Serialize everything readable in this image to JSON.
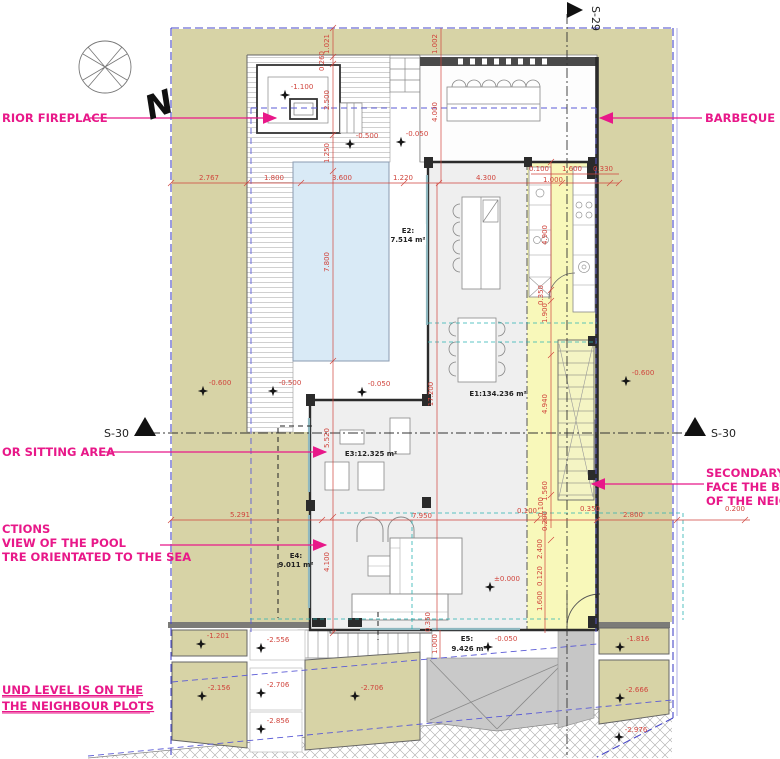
{
  "colors": {
    "plot_khaki": "#d7d3a6",
    "pool_blue": "#d9eaf6",
    "service_yellow": "#f8f8b6",
    "annotation_pink": "#e81889",
    "dimension_red": "#d0443c",
    "boundary_blue": "#4848c8",
    "canopy_cyan": "#2ab3b3"
  },
  "icons": {
    "level_marker": "four-point-star",
    "section_marker": "filled-triangle",
    "callout_arrow": "filled-arrow",
    "compass": "compass-rose"
  },
  "compass": {
    "north": "N"
  },
  "sections": {
    "top": "S-29",
    "left": "S-30",
    "right": "S-30"
  },
  "callouts": {
    "fireplace": "RIOR FIREPLACE",
    "barbeque": "BARBEQUE",
    "sitting_area": "OR SITTING AREA",
    "pool_note": [
      "CTIONS",
      "VIEW OF THE POOL",
      "TRE ORIENTATED TO THE SEA"
    ],
    "secondary_note": [
      "SECONDARY F",
      "FACE THE BLI",
      "OF THE NEIGH"
    ],
    "ground_note": [
      "UND LEVEL IS ON THE",
      "THE NEIGHBOUR PLOTS"
    ]
  },
  "rooms": {
    "e1": "E1:134.236 m²",
    "e2_name": "E2:",
    "e2_area": "7.514 m²",
    "e3": "E3:12.325 m²",
    "e4_name": "E4:",
    "e4_area": "9.011 m²",
    "e5_name": "E5:",
    "e5_area": "9.426 m²"
  },
  "dims_h": [
    "2.767",
    "1.800",
    "3.600",
    "1.220",
    "4.300",
    "0.100",
    "1.600",
    "0.330",
    "1.000",
    "5.291",
    "7.950",
    "0.100",
    "0.350",
    "2.800",
    "0.200"
  ],
  "dims_v": [
    "1.021",
    "0.260",
    "2.500",
    "1.250",
    "7.800",
    "5.520",
    "4.100",
    "1.002",
    "4.000",
    "17.200",
    "4.900",
    "0.350",
    "1.900",
    "4.940",
    "1.560",
    "0.100",
    "0.200",
    "2.400",
    "0.120",
    "1.600",
    "1.000",
    "0.350"
  ],
  "levels": [
    "-1.100",
    "-0.500",
    "-0.050",
    "-0.600",
    "-0.500",
    "-0.050",
    "-0.600",
    "±0.000",
    "-0.050",
    "-1.201",
    "-2.556",
    "-2.156",
    "-2.706",
    "-2.856",
    "-2.706",
    "-1.816",
    "-2.666",
    "-2.976"
  ]
}
